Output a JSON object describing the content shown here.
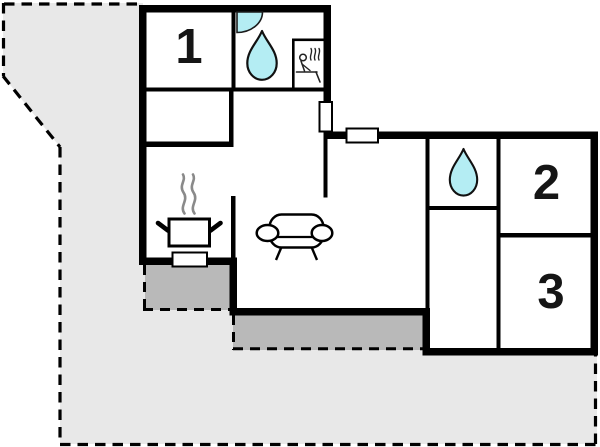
{
  "document": {
    "type": "holiday-home-floor-plan"
  },
  "rooms": [
    {
      "id": "bedroom-1",
      "label": "1"
    },
    {
      "id": "bedroom-2",
      "label": "2"
    },
    {
      "id": "bedroom-3",
      "label": "3"
    }
  ],
  "icons": {
    "bathroom_top": [
      "corner-shower-icon",
      "water-drop-icon",
      "sauna-icon"
    ],
    "bathroom_right": [
      "water-drop-icon"
    ],
    "kitchen": [
      "stove-pot-icon",
      "steam-icon"
    ],
    "living_room": [
      "sofa-icon"
    ],
    "walls": [
      "window-marker",
      "window-marker",
      "window-marker"
    ]
  },
  "colors": {
    "water": "#b4edf3",
    "terrace": "#b9b9b9",
    "plot": "#e8e8e8",
    "wall": "#000000",
    "steam": "#8a8a8a",
    "label": "#151515"
  }
}
